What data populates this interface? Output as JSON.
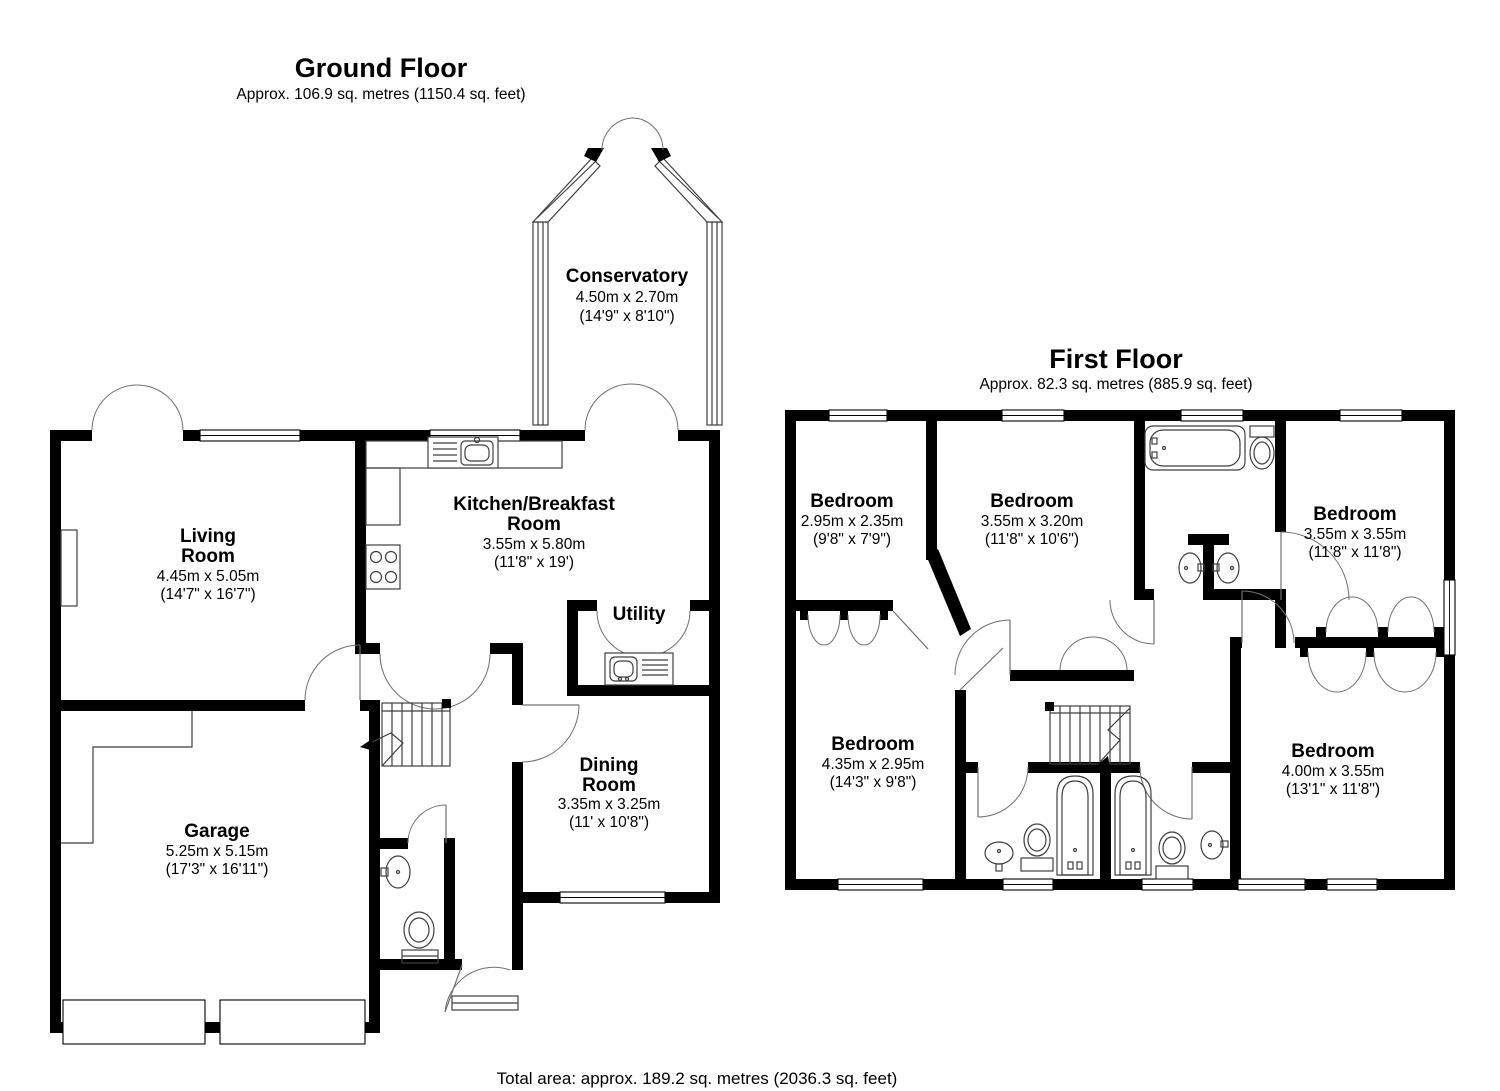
{
  "ground_floor": {
    "title": "Ground Floor",
    "subtitle": "Approx. 106.9 sq. metres (1150.4 sq. feet)",
    "rooms": {
      "conservatory": {
        "lines": [
          "Conservatory",
          "4.50m x 2.70m",
          "(14'9\" x 8'10\")"
        ]
      },
      "living_room": {
        "lines": [
          "Living",
          "Room",
          "4.45m x 5.05m",
          "(14'7\" x 16'7\")"
        ]
      },
      "kitchen": {
        "lines": [
          "Kitchen/Breakfast",
          "Room",
          "3.55m x 5.80m",
          "(11'8\" x 19')"
        ]
      },
      "utility": {
        "lines": [
          "Utility"
        ]
      },
      "dining_room": {
        "lines": [
          "Dining",
          "Room",
          "3.35m x 3.25m",
          "(11' x 10'8\")"
        ]
      },
      "garage": {
        "lines": [
          "Garage",
          "5.25m x 5.15m",
          "(17'3\" x 16'11\")"
        ]
      }
    }
  },
  "first_floor": {
    "title": "First Floor",
    "subtitle": "Approx. 82.3 sq. metres (885.9 sq. feet)",
    "rooms": {
      "bedroom_top_left": {
        "lines": [
          "Bedroom",
          "2.95m x 2.35m",
          "(9'8\" x 7'9\")"
        ]
      },
      "bedroom_top_middle": {
        "lines": [
          "Bedroom",
          "3.55m x 3.20m",
          "(11'8\" x 10'6\")"
        ]
      },
      "bedroom_top_right": {
        "lines": [
          "Bedroom",
          "3.55m x 3.55m",
          "(11'8\" x 11'8\")"
        ]
      },
      "bedroom_bottom_left": {
        "lines": [
          "Bedroom",
          "4.35m x 2.95m",
          "(14'3\" x 9'8\")"
        ]
      },
      "bedroom_bottom_right": {
        "lines": [
          "Bedroom",
          "4.00m x 3.55m",
          "(13'1\" x 11'8\")"
        ]
      }
    }
  },
  "footer": {
    "total_area": "Total area: approx. 189.2 sq. metres (2036.3 sq. feet)"
  },
  "colors": {
    "wall": "#000000",
    "thin_line": "#3f3f3f",
    "door_arc": "#707070",
    "background": "#ffffff"
  }
}
